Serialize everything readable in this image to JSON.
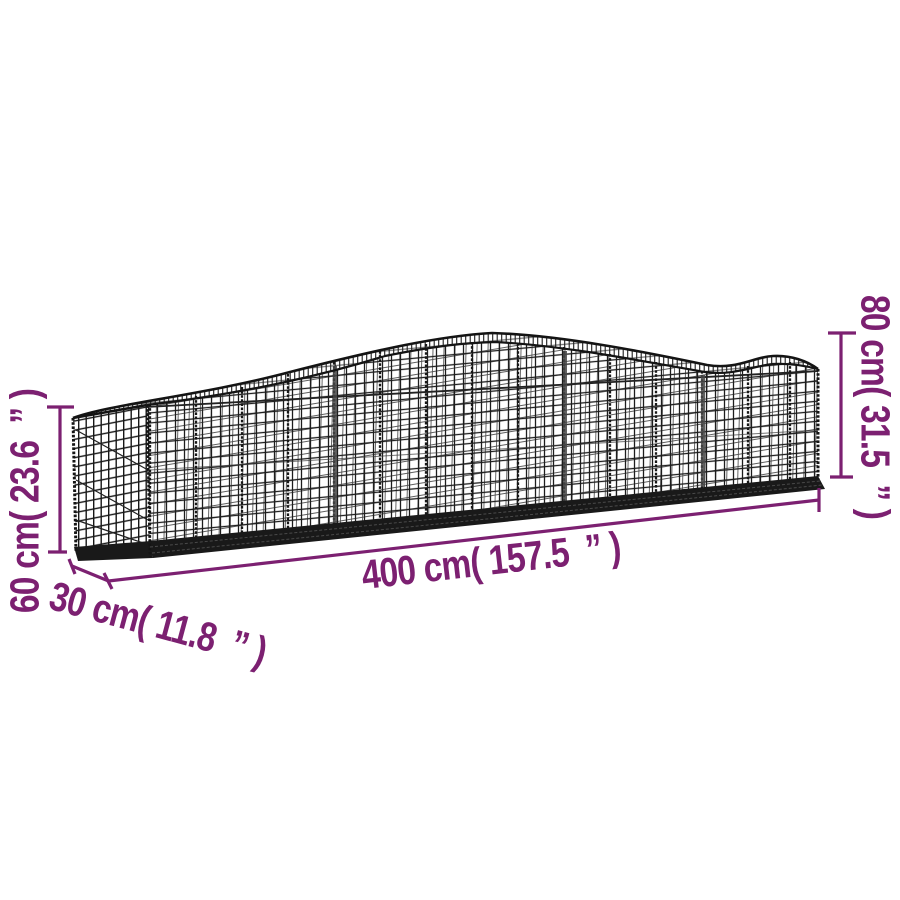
{
  "colors": {
    "background": "#ffffff",
    "dimension": "#7c2071",
    "wire": "#1d1d1d"
  },
  "illustration": {
    "icon": "gabion-basket-mesh-illustration"
  },
  "dimensions": {
    "max_height": {
      "label": "80 cm( 31.5  ” )"
    },
    "end_height": {
      "label": "60 cm( 23.6  ” )"
    },
    "length": {
      "label": "400 cm( 157.5  ” )"
    },
    "depth": {
      "label": "30 cm( 11.8  ” )"
    }
  }
}
